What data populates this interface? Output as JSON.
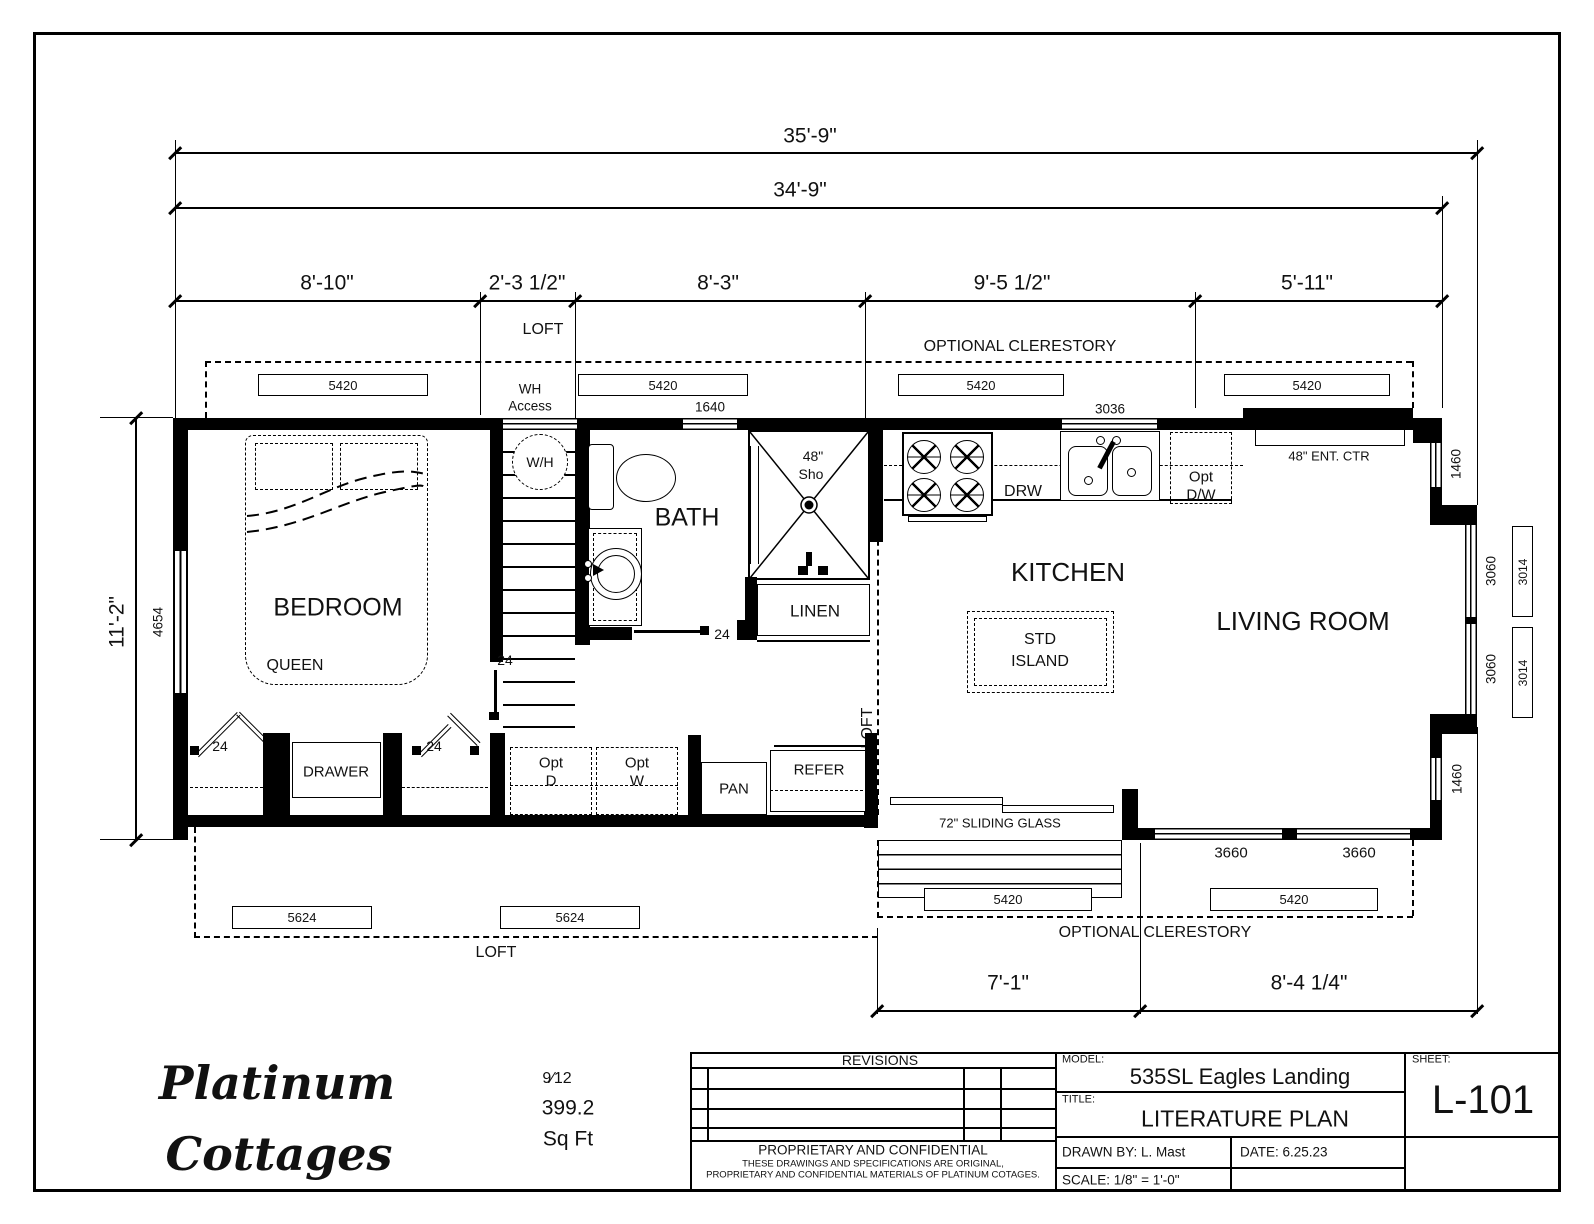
{
  "dims": {
    "overall_with_bay": "35'-9\"",
    "overall": "34'-9\"",
    "seg_bedroom": "8'-10\"",
    "seg_stairs": "2'-3 1/2\"",
    "seg_bath": "8'-3\"",
    "seg_kitchen": "9'-5 1/2\"",
    "seg_living": "5'-11\"",
    "width": "11'-2\"",
    "seg_slider": "7'-1\"",
    "seg_patio": "8'-4 1/4\""
  },
  "windows": {
    "clerestory_top": [
      "5420",
      "5420",
      "5420",
      "5420"
    ],
    "loft_bottom": [
      "5624",
      "5624"
    ],
    "clerestory_bottom": [
      "5420",
      "5420"
    ],
    "top_wall": [
      "1640",
      "3036"
    ],
    "left_wall": "4654",
    "right_wall": [
      "1460",
      "3060",
      "3014",
      "3060",
      "3014",
      "1460"
    ],
    "bottom_wall": [
      "3660",
      "3660"
    ]
  },
  "doors": {
    "closet_left": "24",
    "closet_right": "24",
    "bedroom": "24",
    "bath": "24",
    "slider": "72\" SLIDING GLASS"
  },
  "areas": {
    "loft_top": "LOFT",
    "loft_bottom": "LOFT",
    "loft_side": "LOFT",
    "clerestory_top": "OPTIONAL CLERESTORY",
    "clerestory_bottom": "OPTIONAL CLERESTORY"
  },
  "rooms": {
    "bedroom": "BEDROOM",
    "bath": "BATH",
    "kitchen": "KITCHEN",
    "living": "LIVING ROOM"
  },
  "fixtures": {
    "queen": "QUEEN",
    "drawer": "DRAWER",
    "wh_line1": "WH",
    "wh_line2": "Access",
    "wh_tank": "W/H",
    "shower_line1": "48\"",
    "shower_line2": "Sho",
    "linen": "LINEN",
    "drw": "DRW",
    "opt_dw_line1": "Opt",
    "opt_dw_line2": "D/W",
    "island_line1": "STD",
    "island_line2": "ISLAND",
    "opt_d_line1": "Opt",
    "opt_d_line2": "D",
    "opt_w_line1": "Opt",
    "opt_w_line2": "W",
    "pan": "PAN",
    "refer": "REFER",
    "ent_ctr": "48\" ENT. CTR"
  },
  "title_block": {
    "revisions": "REVISIONS",
    "proprietary_title": "PROPRIETARY AND CONFIDENTIAL",
    "proprietary_line1": "THESE DRAWINGS AND SPECIFICATIONS ARE ORIGINAL,",
    "proprietary_line2": "PROPRIETARY AND CONFIDENTIAL MATERIALS OF PLATINUM COTAGES.",
    "model_label": "MODEL:",
    "model": "535SL Eagles Landing",
    "title_label": "TITLE:",
    "title": "LITERATURE PLAN",
    "drawn_by": "DRAWN BY: L. Mast",
    "date": "DATE: 6.25.23",
    "scale": "SCALE: 1/8\" = 1'-0\"",
    "sheet_label": "SHEET:",
    "sheet": "L-101"
  },
  "logo": {
    "line1": "Platinum",
    "line2": "Cottages",
    "roof_pitch": "9⁄12",
    "area": "399.2",
    "area_unit": "Sq Ft"
  }
}
